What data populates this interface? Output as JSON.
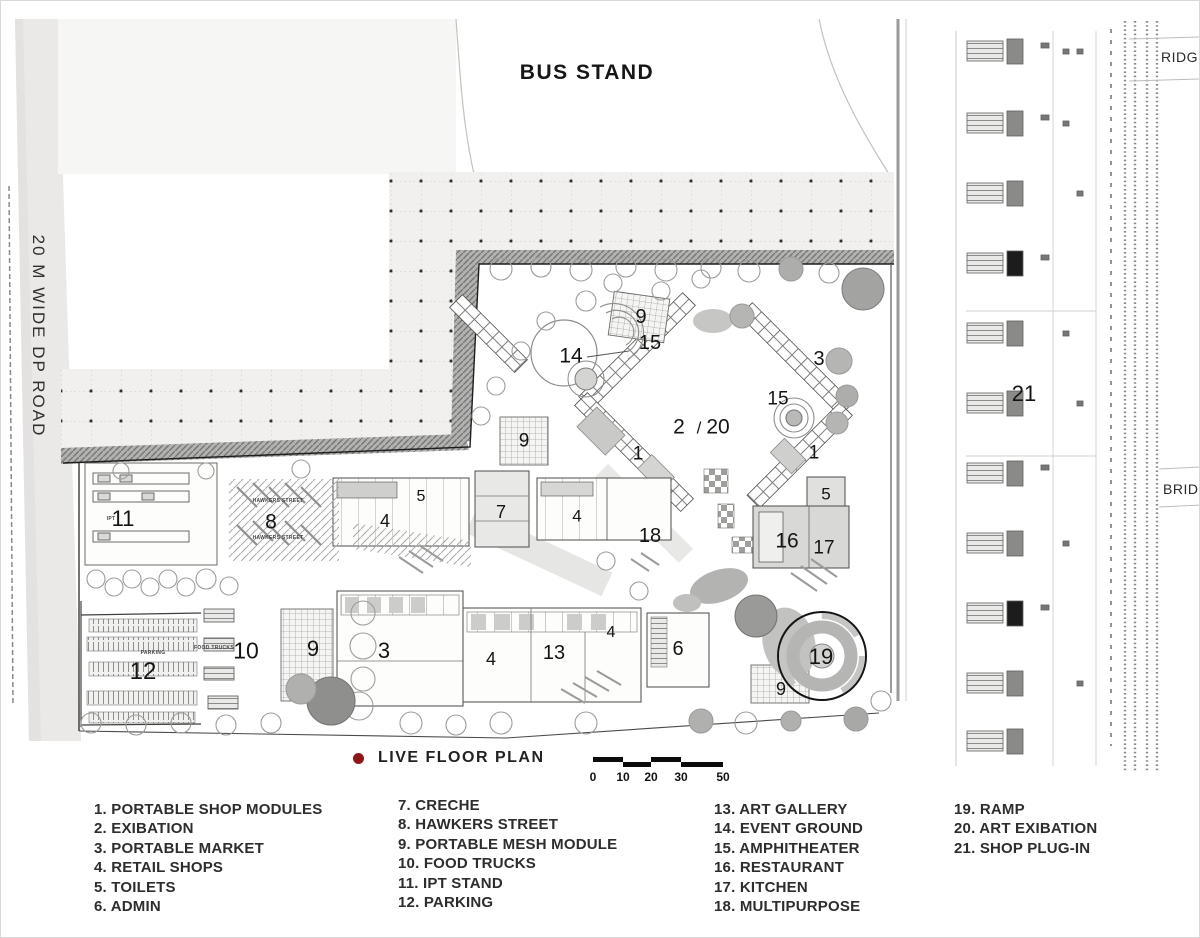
{
  "titles": {
    "bus_stand": "BUS STAND",
    "road": "20 M WIDE DP ROAD",
    "ridge": "RIDGE",
    "bridge": "BRIDGE"
  },
  "key": {
    "dot_color": "#8e1616",
    "label": "LIVE  FLOOR PLAN"
  },
  "scale_bar": {
    "ticks": [
      {
        "text": "0",
        "x": 592
      },
      {
        "text": "10",
        "x": 622
      },
      {
        "text": "20",
        "x": 650
      },
      {
        "text": "30",
        "x": 680
      },
      {
        "text": "50",
        "x": 722
      }
    ],
    "segments": [
      {
        "x": 592,
        "y": 756,
        "w": 30
      },
      {
        "x": 622,
        "y": 761,
        "w": 28
      },
      {
        "x": 650,
        "y": 756,
        "w": 30
      },
      {
        "x": 680,
        "y": 761,
        "w": 42
      }
    ]
  },
  "legend": {
    "columns": [
      {
        "x": 93,
        "y": 799,
        "items": [
          "1. PORTABLE SHOP MODULES",
          "2. EXIBATION",
          "3. PORTABLE MARKET",
          "4. RETAIL SHOPS",
          "5. TOILETS",
          "6. ADMIN"
        ]
      },
      {
        "x": 397,
        "y": 795,
        "items": [
          "7. CRECHE",
          "8. HAWKERS STREET",
          "9. PORTABLE MESH MODULE",
          "10. FOOD TRUCKS",
          "11. IPT STAND",
          "12. PARKING"
        ]
      },
      {
        "x": 713,
        "y": 799,
        "items": [
          "13. ART GALLERY",
          "14. EVENT GROUND",
          "15. AMPHITHEATER",
          "16. RESTAURANT",
          "17. KITCHEN",
          "18. MULTIPURPOSE"
        ]
      },
      {
        "x": 953,
        "y": 799,
        "items": [
          "19. RAMP",
          "20. ART EXIBATION",
          "21. SHOP PLUG-IN"
        ]
      }
    ]
  },
  "plan": {
    "markers": [
      {
        "label": "9",
        "x": 640,
        "y": 316,
        "size": 20
      },
      {
        "label": "15",
        "x": 649,
        "y": 342,
        "size": 20
      },
      {
        "label": "14",
        "x": 570,
        "y": 355,
        "size": 21
      },
      {
        "label": "3",
        "x": 818,
        "y": 358,
        "size": 20
      },
      {
        "label": "15",
        "x": 777,
        "y": 398,
        "size": 19
      },
      {
        "label": "2",
        "x": 678,
        "y": 426,
        "size": 21
      },
      {
        "label": "/",
        "x": 698,
        "y": 427,
        "size": 17
      },
      {
        "label": "20",
        "x": 717,
        "y": 426,
        "size": 21
      },
      {
        "label": "1",
        "x": 637,
        "y": 453,
        "size": 19
      },
      {
        "label": "9",
        "x": 523,
        "y": 440,
        "size": 19
      },
      {
        "label": "1",
        "x": 813,
        "y": 452,
        "size": 19
      },
      {
        "label": "5",
        "x": 420,
        "y": 496,
        "size": 16
      },
      {
        "label": "11",
        "x": 122,
        "y": 518,
        "size": 22
      },
      {
        "label": "8",
        "x": 270,
        "y": 521,
        "size": 21
      },
      {
        "label": "4",
        "x": 384,
        "y": 520,
        "size": 18
      },
      {
        "label": "7",
        "x": 500,
        "y": 511,
        "size": 18
      },
      {
        "label": "4",
        "x": 576,
        "y": 515,
        "size": 17
      },
      {
        "label": "18",
        "x": 649,
        "y": 535,
        "size": 20
      },
      {
        "label": "5",
        "x": 825,
        "y": 493,
        "size": 17
      },
      {
        "label": "16",
        "x": 786,
        "y": 540,
        "size": 21
      },
      {
        "label": "17",
        "x": 823,
        "y": 547,
        "size": 19
      },
      {
        "label": "12",
        "x": 142,
        "y": 671,
        "size": 24
      },
      {
        "label": "10",
        "x": 245,
        "y": 650,
        "size": 23
      },
      {
        "label": "9",
        "x": 312,
        "y": 648,
        "size": 22
      },
      {
        "label": "3",
        "x": 383,
        "y": 650,
        "size": 22
      },
      {
        "label": "4",
        "x": 490,
        "y": 658,
        "size": 18
      },
      {
        "label": "13",
        "x": 553,
        "y": 652,
        "size": 20
      },
      {
        "label": "4",
        "x": 610,
        "y": 632,
        "size": 16
      },
      {
        "label": "6",
        "x": 677,
        "y": 648,
        "size": 20
      },
      {
        "label": "19",
        "x": 820,
        "y": 656,
        "size": 22
      },
      {
        "label": "9",
        "x": 780,
        "y": 688,
        "size": 18
      },
      {
        "label": "21",
        "x": 1023,
        "y": 393,
        "size": 22
      }
    ],
    "micro_labels": [
      {
        "text": "HAWKERS STREET",
        "x": 277,
        "y": 500
      },
      {
        "text": "HAWKERS STREET",
        "x": 277,
        "y": 537
      },
      {
        "text": "PARKING",
        "x": 152,
        "y": 652
      },
      {
        "text": "FOOD TRUCKS",
        "x": 213,
        "y": 647
      },
      {
        "text": "IPT",
        "x": 110,
        "y": 518
      }
    ]
  }
}
